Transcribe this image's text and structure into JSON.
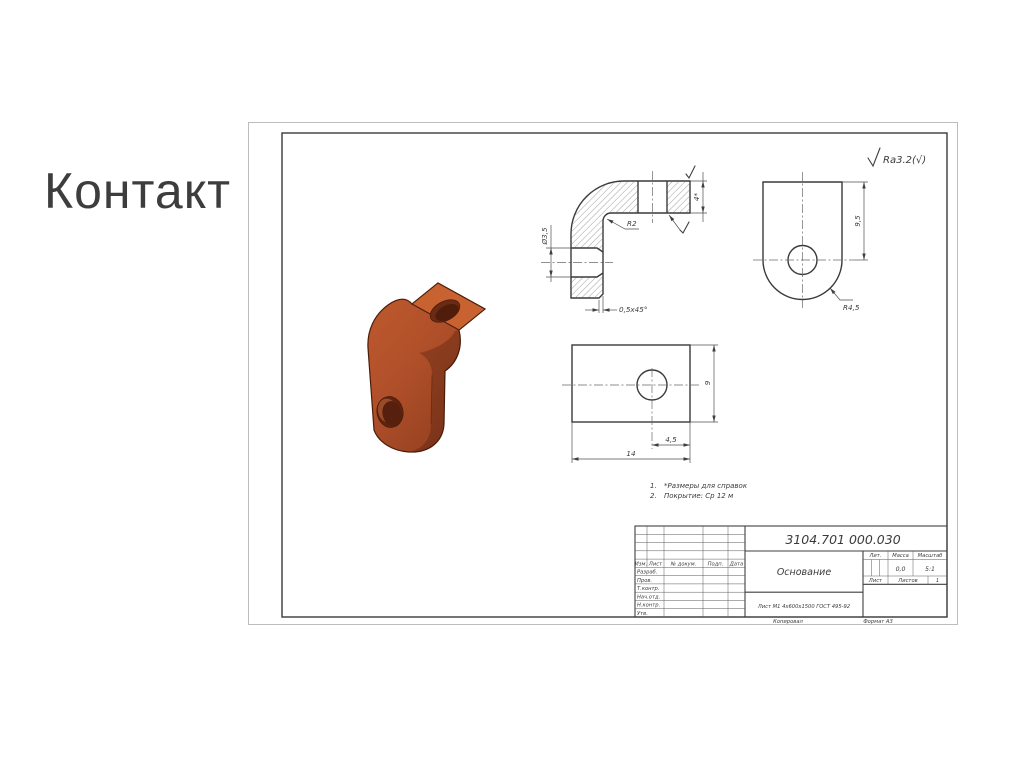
{
  "slide": {
    "title": "Контакт"
  },
  "drawing": {
    "surface_finish": "Ra3.2(√)",
    "notes": [
      {
        "num": "1.",
        "text": "*Размеры для справок"
      },
      {
        "num": "2.",
        "text": "Покрытие: Ср 12 м"
      }
    ],
    "dims": {
      "hole_dia": "Ø3,5",
      "bend_radius": "R2",
      "chamfer": "0,5x45°",
      "thickness": "4*",
      "height_to_hole": "9,5",
      "end_radius": "R4,5",
      "hole_offset": "4,5",
      "length": "14",
      "width": "9"
    },
    "title_block": {
      "designation": "3104.701 000.030",
      "part_name": "Основание",
      "material": "Лист М1 4х600х1500 ГОСТ 495-92",
      "cols": {
        "change": "Изм.",
        "sheet": "Лист",
        "doc": "№ докум.",
        "sign": "Подп.",
        "date": "Дата"
      },
      "rows": [
        "Разраб.",
        "Пров.",
        "Т.контр.",
        "Нач.отд.",
        "Н.контр.",
        "Утв."
      ],
      "lit_label": "Лит.",
      "mass_label": "Масса",
      "scale_label": "Масштаб",
      "mass": "0,0",
      "scale": "5:1",
      "sheet_label": "Лист",
      "sheets_label": "Листов",
      "sheets_count": "1",
      "copied": "Копировал",
      "format": "Формат А3"
    }
  }
}
